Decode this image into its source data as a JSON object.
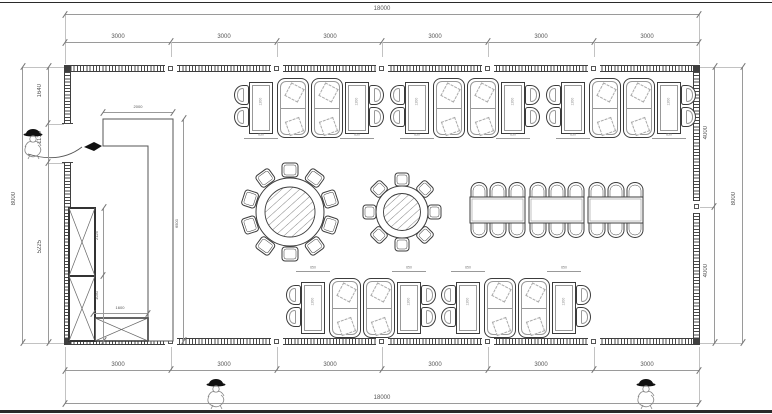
{
  "dims": {
    "top_overall": "18000",
    "top_segments": [
      "3000",
      "3000",
      "3000",
      "3000",
      "3000",
      "3000"
    ],
    "bottom_overall": "18000",
    "bottom_segments": [
      "3000",
      "3000",
      "3000",
      "3000",
      "3000",
      "3000"
    ],
    "left_overall": "8000",
    "left_segments": [
      "1640",
      "1135",
      "5225"
    ],
    "right_overall": "8000",
    "right_segments": [
      "4000",
      "4000"
    ],
    "table_length": "1200",
    "table_width": "650",
    "counter_width": "2000",
    "counter_length": "6500",
    "cabinet_upper": "2125",
    "cabinet_lower": "1030",
    "cabinet_bottom_width": "1600"
  }
}
